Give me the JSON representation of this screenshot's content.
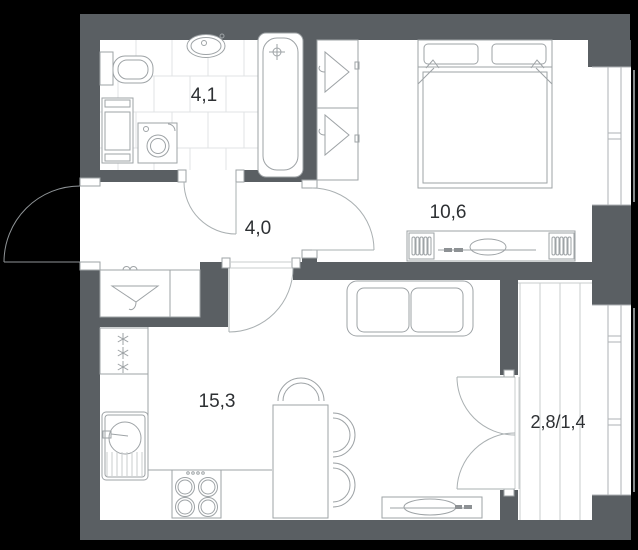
{
  "plan": {
    "type": "apartment-floor-plan",
    "rooms": [
      {
        "name": "bathroom",
        "area": "4,1"
      },
      {
        "name": "hallway",
        "area": "4,0"
      },
      {
        "name": "bedroom",
        "area": "10,6"
      },
      {
        "name": "living-kitchen",
        "area": "15,3"
      },
      {
        "name": "balcony",
        "area": "2,8/1,4"
      }
    ],
    "colors": {
      "background": "#000000",
      "wall": "#5a5f63",
      "furniture_line": "#9ea3a6",
      "light_line": "#c9cdce",
      "tile_line": "#e0e3e4",
      "label_text": "#2d3033"
    }
  }
}
